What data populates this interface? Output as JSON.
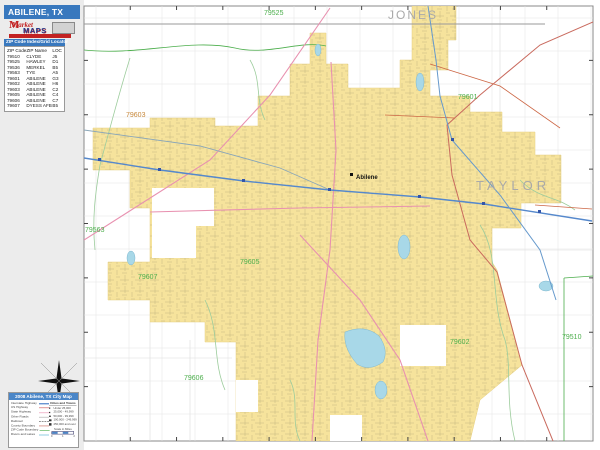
{
  "header": {
    "title": "ABILENE, TX"
  },
  "logo": {
    "word1": "Market",
    "word2": "MAPS"
  },
  "locator": {
    "header": "ZIP Code Index/Grid Locator",
    "columns": [
      "ZIP Code",
      "ZIP Name",
      "LOC"
    ],
    "rows": [
      [
        "79510",
        "CLYDE",
        "J5"
      ],
      [
        "79525",
        "HAWLEY",
        "D1"
      ],
      [
        "79536",
        "MERKEL",
        "B5"
      ],
      [
        "79563",
        "TYE",
        "A5"
      ],
      [
        "79601",
        "ABILENE",
        "G3"
      ],
      [
        "79602",
        "ABILENE",
        "H6"
      ],
      [
        "79603",
        "ABILENE",
        "C2"
      ],
      [
        "79605",
        "ABILENE",
        "C4"
      ],
      [
        "79606",
        "ABILENE",
        "C7"
      ],
      [
        "79607",
        "DYESS AFB",
        "B5"
      ]
    ]
  },
  "legend": {
    "title": "2008 Abilene, TX City Map",
    "road_items": [
      {
        "label": "Interstate Highway",
        "color": "#5588cc",
        "w": 2,
        "dash": ""
      },
      {
        "label": "US Highway",
        "color": "#cc5555",
        "w": 1.5,
        "dash": ""
      },
      {
        "label": "State Highway",
        "color": "#e891b0",
        "w": 1.5,
        "dash": ""
      },
      {
        "label": "Other Roads",
        "color": "#aaaaaa",
        "w": 1,
        "dash": ""
      },
      {
        "label": "Railroad",
        "color": "#555555",
        "w": 1,
        "dash": "dashed"
      },
      {
        "label": "County Boundary",
        "color": "#c96a5e",
        "w": 1,
        "dash": ""
      },
      {
        "label": "ZIP Code Boundary",
        "color": "#4cae4c",
        "w": 1,
        "dash": ""
      },
      {
        "label": "Rivers and Lakes",
        "color": "#a8d8e8",
        "w": 2,
        "dash": ""
      }
    ],
    "cities_title": "Cities and Towns",
    "population_items": [
      "Under 25,000",
      "25,000 - 49,999",
      "50,000 - 99,999",
      "100,000 - 249,999",
      "250,000 and over"
    ],
    "scale": {
      "label": "Scale in Miles",
      "ticks": [
        "0",
        "1",
        "2"
      ]
    }
  },
  "map": {
    "labels": [
      {
        "text": "JONES",
        "x": 388,
        "y": 19,
        "size": 12,
        "color": "#a9a9a9",
        "ls": 2,
        "bold": false
      },
      {
        "text": "TAYLOR",
        "x": 476,
        "y": 190,
        "size": 13,
        "color": "#a9a9a9",
        "ls": 4,
        "bold": false
      },
      {
        "text": "Abilene",
        "x": 356,
        "y": 179,
        "size": 6,
        "color": "#111111",
        "ls": 0,
        "bold": true
      },
      {
        "text": "79525",
        "x": 264,
        "y": 15,
        "size": 7,
        "color": "#4cae4c",
        "ls": 0,
        "bold": false
      },
      {
        "text": "79601",
        "x": 458,
        "y": 99,
        "size": 7,
        "color": "#4cae4c",
        "ls": 0,
        "bold": false
      },
      {
        "text": "79603",
        "x": 126,
        "y": 117,
        "size": 7,
        "color": "#c8893c",
        "ls": 0,
        "bold": false
      },
      {
        "text": "79563",
        "x": 85,
        "y": 232,
        "size": 7,
        "color": "#4cae4c",
        "ls": 0,
        "bold": false
      },
      {
        "text": "79607",
        "x": 138,
        "y": 279,
        "size": 7,
        "color": "#4cae4c",
        "ls": 0,
        "bold": false
      },
      {
        "text": "79605",
        "x": 240,
        "y": 264,
        "size": 7,
        "color": "#4cae4c",
        "ls": 0,
        "bold": false
      },
      {
        "text": "79606",
        "x": 184,
        "y": 380,
        "size": 7,
        "color": "#4cae4c",
        "ls": 0,
        "bold": false
      },
      {
        "text": "79602",
        "x": 450,
        "y": 344,
        "size": 7,
        "color": "#4cae4c",
        "ls": 0,
        "bold": false
      },
      {
        "text": "79510",
        "x": 562,
        "y": 339,
        "size": 7,
        "color": "#4cae4c",
        "ls": 0,
        "bold": false
      }
    ],
    "colors": {
      "zip_fill": "#f6e39c",
      "zip_label_green": "#4cae4c",
      "interstate_blue": "#5588cc",
      "county_red": "#c96a5e",
      "water_blue": "#a8d8e8",
      "panel_blue": "#3878be"
    }
  }
}
